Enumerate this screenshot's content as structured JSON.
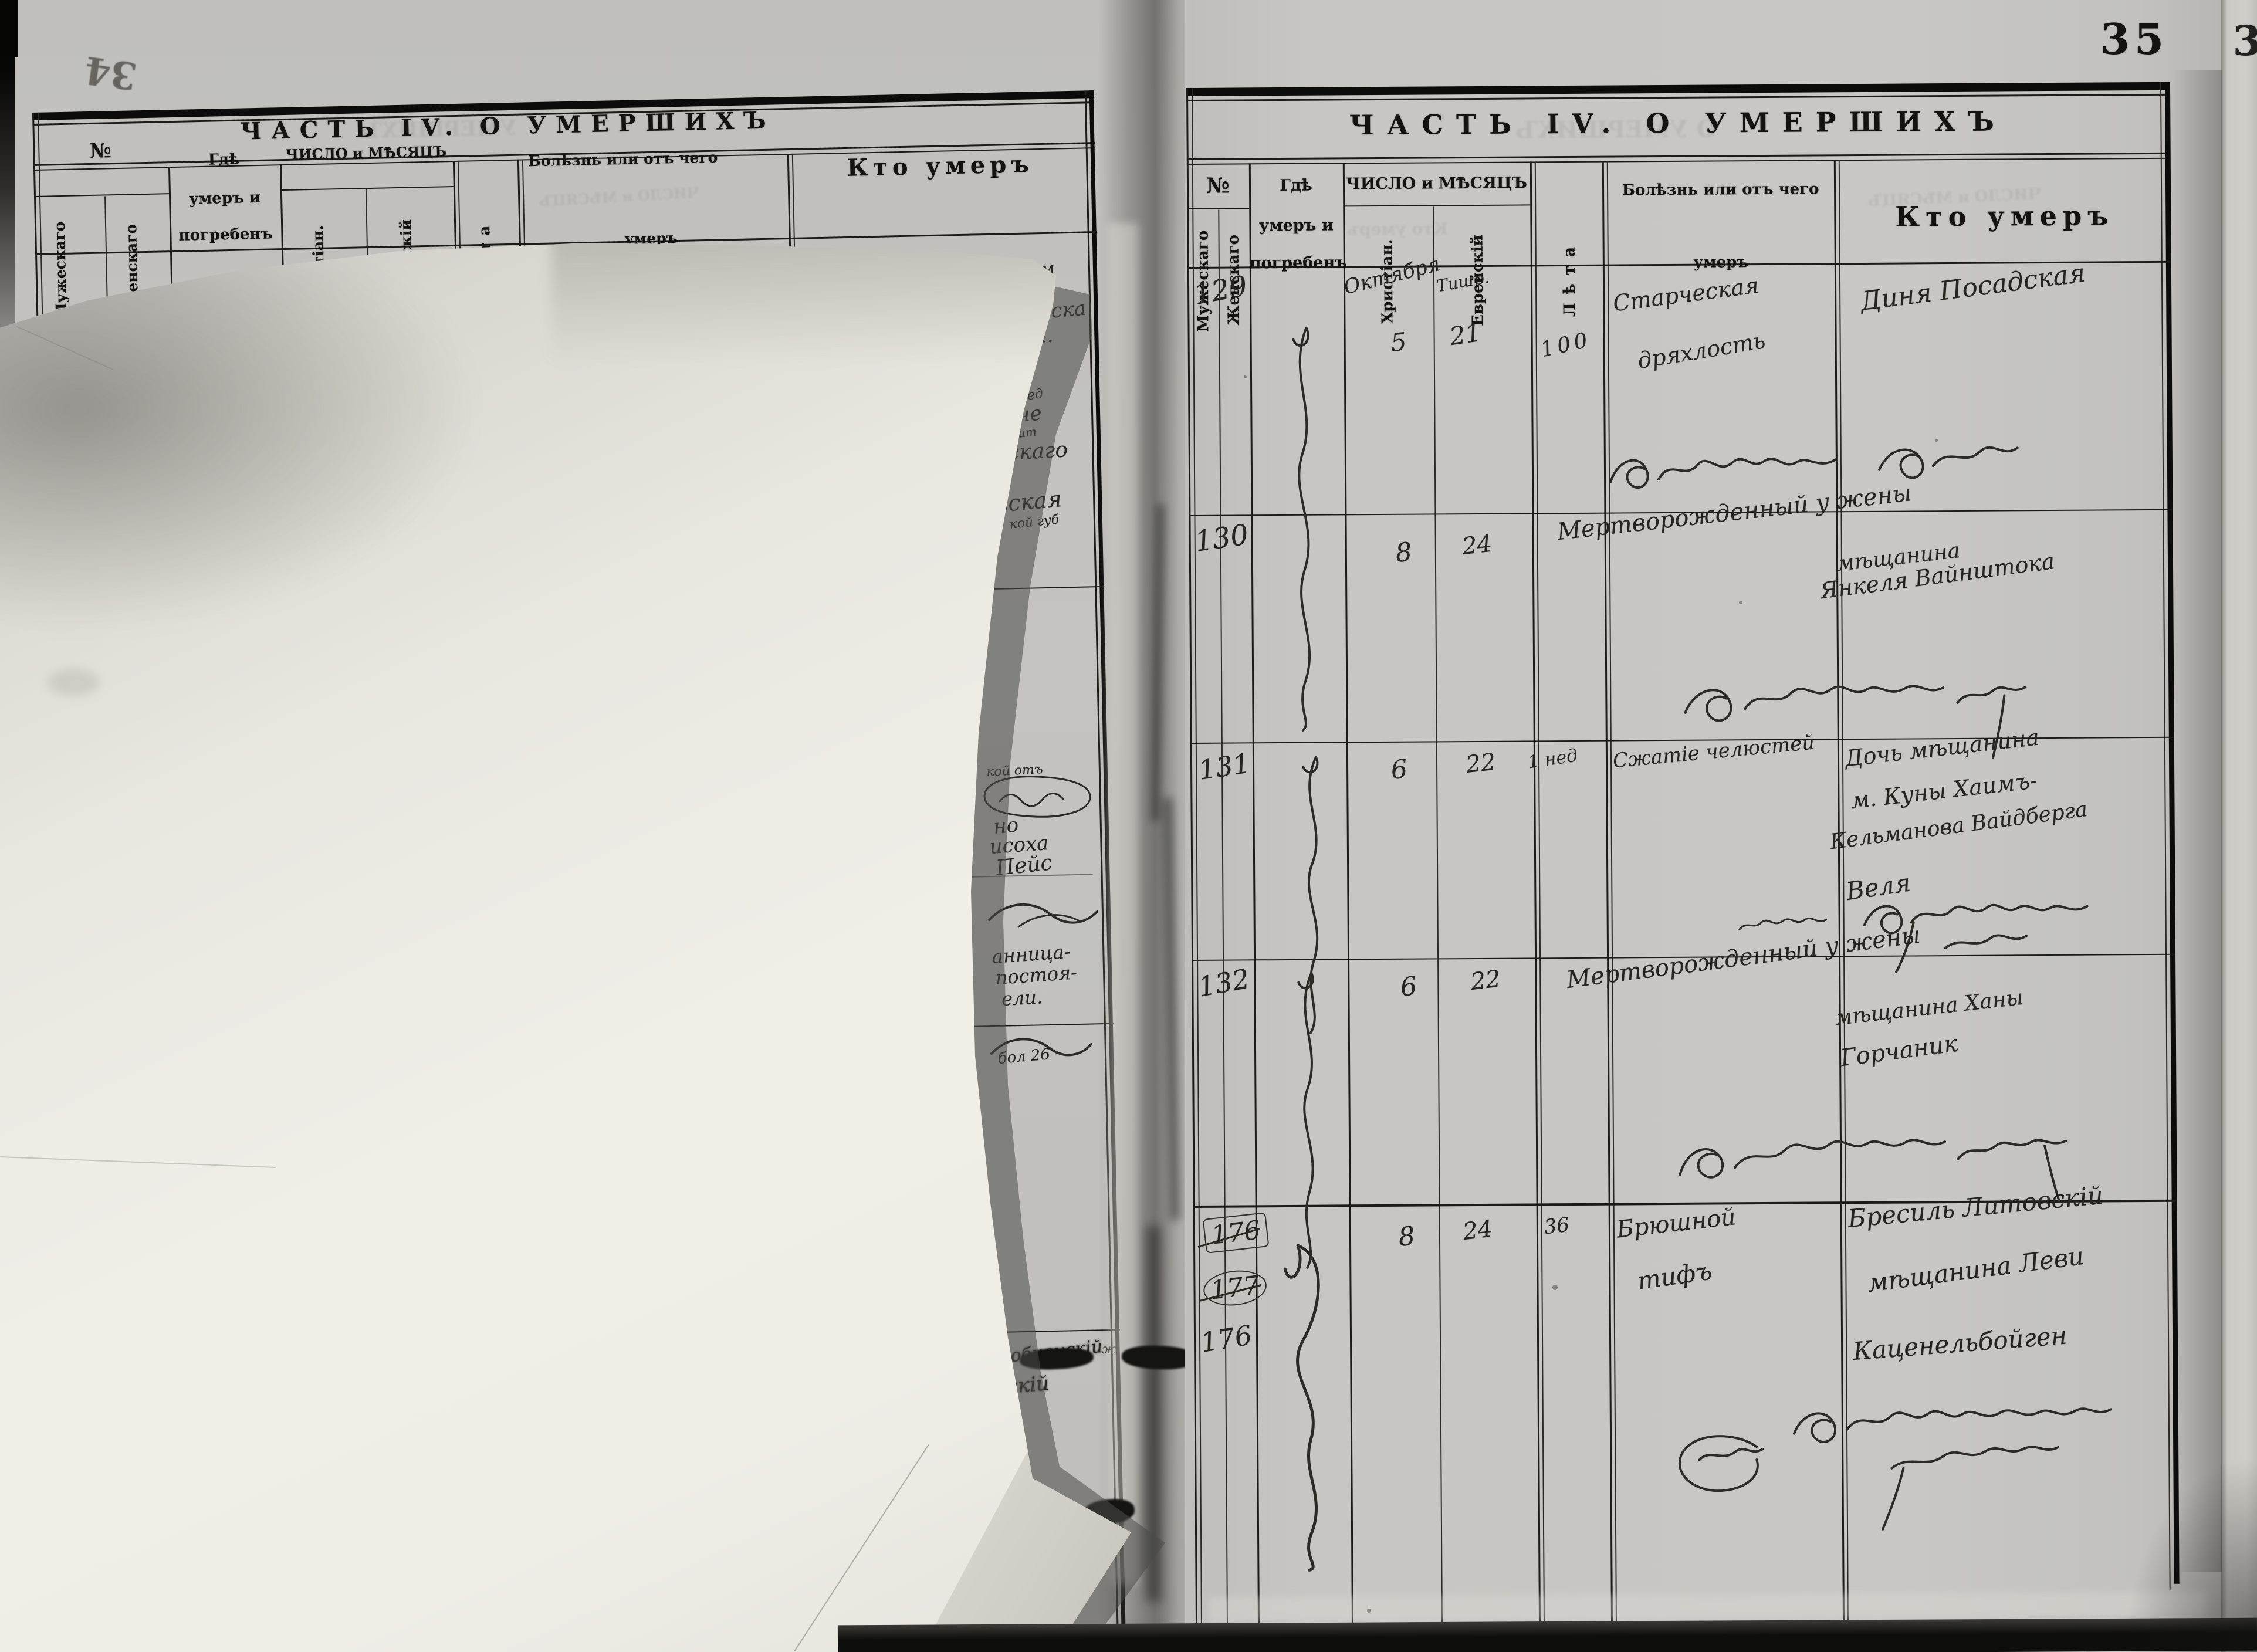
{
  "scan": {
    "page_number": "35",
    "pencil_page_number": "34",
    "adjacent_page_digit": "3"
  },
  "header": {
    "title": "ЧАСТЬ IV. О УМЕРШИХЪ",
    "col_no": "№",
    "col_male": "Мужескаго",
    "col_female": "Женскаго",
    "col_where_l1": "Гдѣ",
    "col_where_l2": "умеръ и",
    "col_where_l3": "погребенъ",
    "col_date": "ЧИСЛО и МѢСЯЦЪ",
    "col_date_christian": "Христіан.",
    "col_date_jewish": "Еврейскій",
    "col_age": "Лѣта",
    "col_cause_l1": "Болѣзнь или отъ чего",
    "col_cause_l2": "умеръ",
    "col_who": "Кто умеръ"
  },
  "rows": [
    {
      "no": "129",
      "month_christian": "Октября",
      "day_christian": "5",
      "month_jewish": "Тишр.",
      "day_jewish": "21",
      "age": "100",
      "cause1": "Старческая",
      "cause2": "дряхлость",
      "who1": "Диня Посадская"
    },
    {
      "no": "130",
      "day_christian": "8",
      "day_jewish": "24",
      "cause_long": "Мертворожденный у жены",
      "who1": "мѣщанина",
      "who2": "Янкеля Вайнштока"
    },
    {
      "no": "131",
      "day_christian": "6",
      "day_jewish": "22",
      "age": "1 нед",
      "cause1": "Сжатіе челюстей",
      "who1": "Дочь мѣщанина",
      "who2": "м. Куны Хаимъ-",
      "who3": "Кельманова Вайдберга",
      "who4": "Веля"
    },
    {
      "no": "132",
      "day_christian": "6",
      "day_jewish": "22",
      "cause_long": "Мертворожденный у жены",
      "who1": "мѣщанина Ханы",
      "who2": "Горчаник"
    },
    {
      "no_struck1": "176",
      "no_struck2": "177",
      "no": "176",
      "day_christian": "8",
      "day_jewish": "24",
      "age": "36",
      "cause1": "Брюшной",
      "cause2": "тифъ",
      "who1": "Бресиль Литовскій",
      "who2": "мѣщанина Леви",
      "who3": "Каценельбойген"
    }
  ],
  "left_fragments": [
    "нским",
    "Льва",
    "ндрейска",
    "кова.",
    "жед",
    "Біче",
    "чит",
    "евскаго",
    "вская",
    "кой губ",
    "кой отъ",
    "но",
    "исоха",
    "Пейс",
    "анница-",
    "постоя-",
    "ели.",
    "бол 26",
    "уробненскій",
    "вскій",
    "ж",
    "s",
    "/с"
  ],
  "bleed_through": {
    "right_title": "О УМЕРШИХЪ",
    "right_date": "ЧИСЛО и МѢСЯЦЪ",
    "right_who": "Кто умеръ",
    "left_title": "УМЕРШИХЪ",
    "left_date": "ЧИСЛО и МѢСЯЦЪ"
  }
}
